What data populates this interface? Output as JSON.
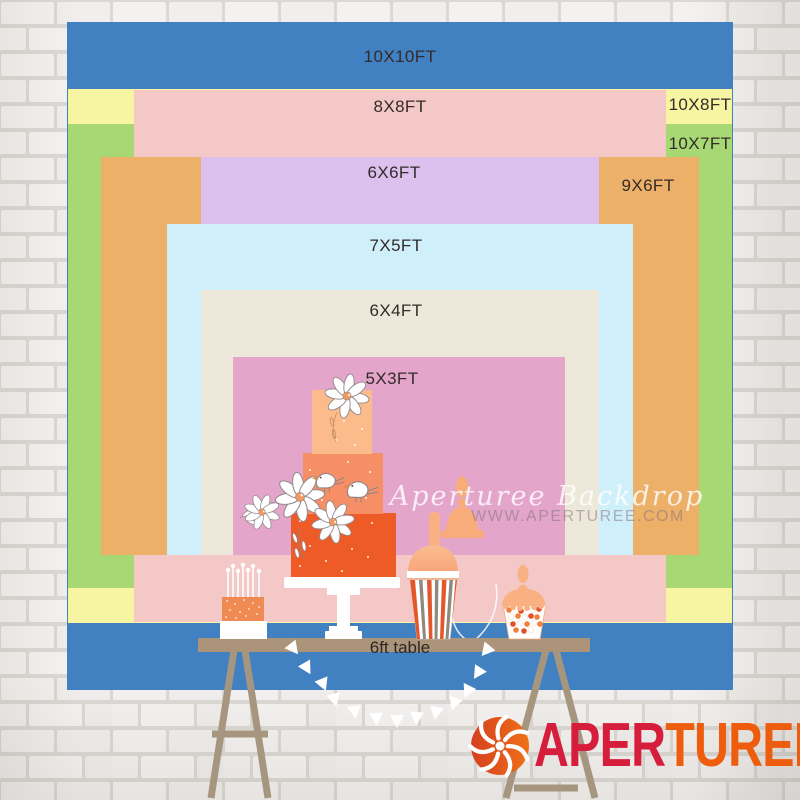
{
  "sizes": [
    {
      "label": "10X10FT",
      "color": "#4181c2"
    },
    {
      "label": "10X8FT",
      "color": "#f7f5a1"
    },
    {
      "label": "10X7FT",
      "color": "#a7d873"
    },
    {
      "label": "8X8FT",
      "color": "#f4c8c7"
    },
    {
      "label": "9X6FT",
      "color": "#ecb069"
    },
    {
      "label": "6X6FT",
      "color": "#dcc0ee"
    },
    {
      "label": "7X5FT",
      "color": "#cfeffa"
    },
    {
      "label": "6X4FT",
      "color": "#ede8d9"
    },
    {
      "label": "5X3FT",
      "color": "#e3a5ca"
    }
  ],
  "table": {
    "label": "6ft table",
    "color": "#ab9479"
  },
  "watermark": {
    "line1": "Aperturee Backdrop",
    "line2": "WWW.APERTUREE.COM"
  },
  "logo": {
    "part1": "APER",
    "part2": "TUREE",
    "color1": "#d61e3c",
    "color2": "#ee5c0e",
    "icon": "aperture-shutter-icon",
    "icon_color": "#e8511d"
  },
  "illustration": {
    "cake_tier_colors": [
      "#fcbb8b",
      "#f78f66",
      "#ee5b26"
    ],
    "silhouette_color": "#f8ac7a",
    "label_text_color": "#332b29"
  }
}
